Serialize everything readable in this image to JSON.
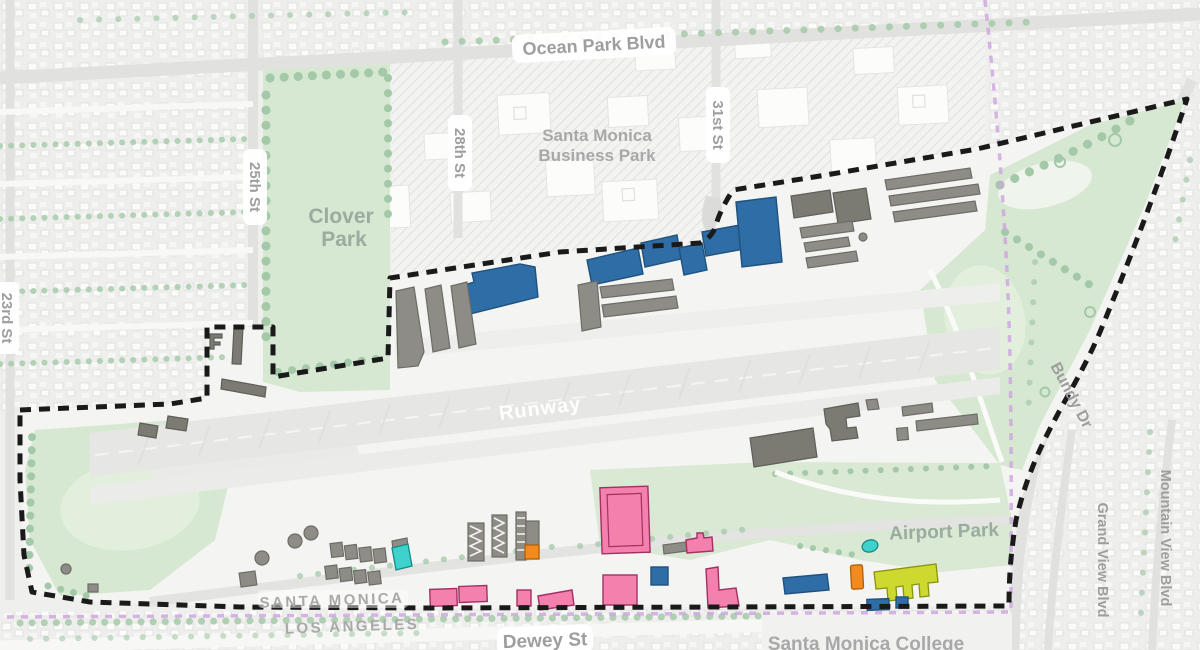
{
  "map": {
    "street_labels": {
      "ocean_park": "Ocean Park Blvd",
      "st23": "23rd St",
      "st25": "25th St",
      "st28": "28th St",
      "st31": "31st St",
      "bundy": "Bundy Dr",
      "grand_view": "Grand View Blvd",
      "mountain_view": "Mountain View Blvd",
      "dewey": "Dewey St"
    },
    "place_labels": {
      "business_park": [
        "Santa Monica",
        "Business Park"
      ],
      "clover_park": [
        "Clover",
        "Park"
      ],
      "runway": "Runway",
      "airport_park": "Airport Park",
      "college": "Santa Monica College"
    },
    "boundary_labels": {
      "north": "SANTA MONICA",
      "south": "LOS ANGELES"
    },
    "colors": {
      "building_blue": "#2E6DA6",
      "building_gray": "#8D8C86",
      "building_dark_gray": "#7B7A73",
      "building_pink": "#F480AE",
      "building_orange": "#F28A1D",
      "building_teal": "#3FD1CB",
      "building_chartreuse": "#CDD92E",
      "airport_boundary_dash": "#1A1A1A",
      "city_boundary_purple": "#CFA7E1",
      "park_green": "#D7E8D2",
      "tree_green": "#A4C9A9",
      "road_gray": "#E1E1DF",
      "label_gray": "#9E9E9E",
      "runway_label_color": "#FFFFFF"
    }
  }
}
